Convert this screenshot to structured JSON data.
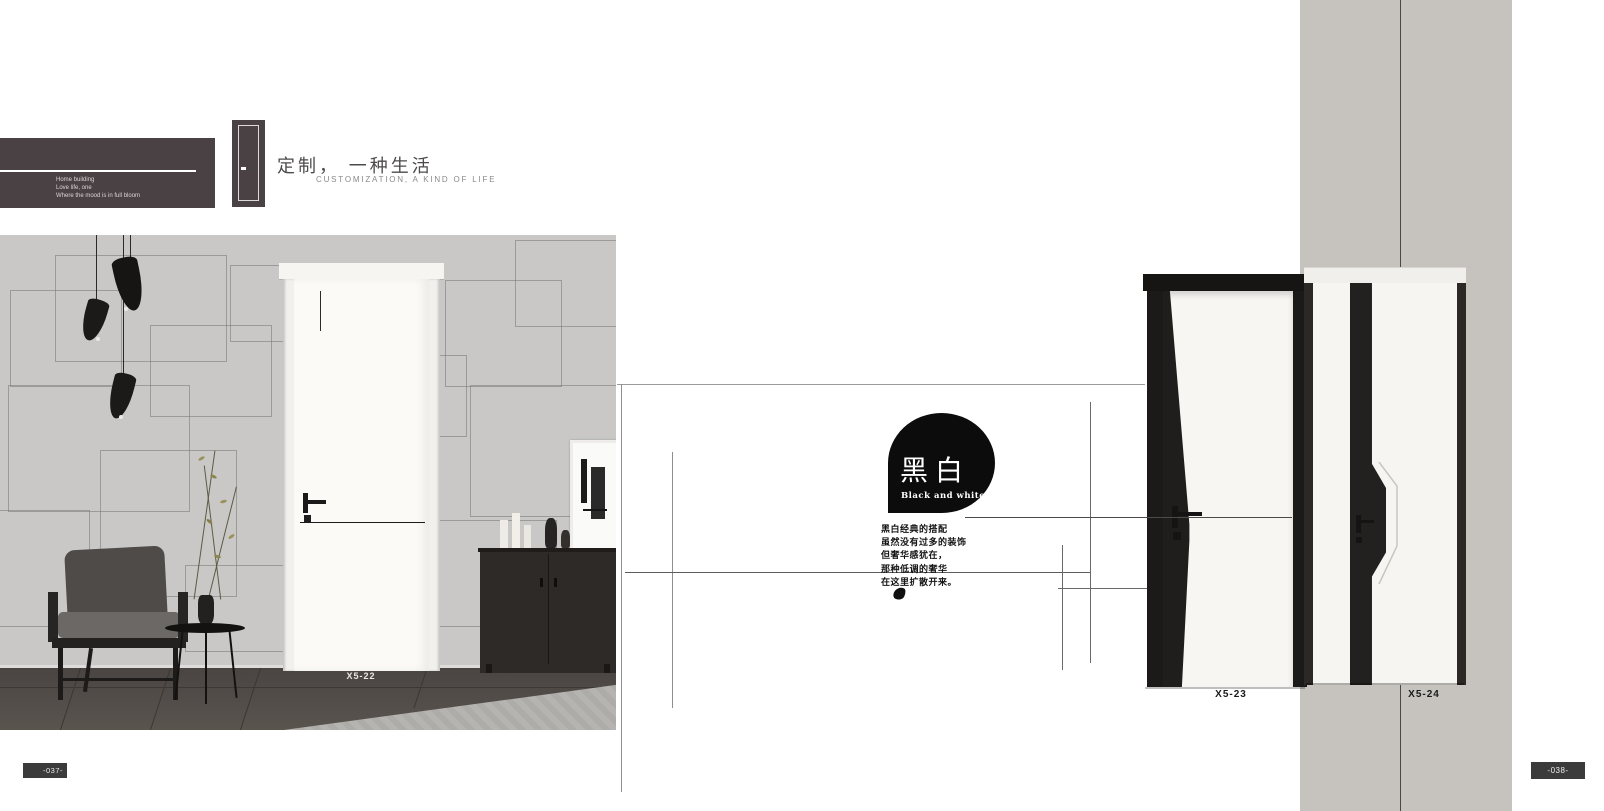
{
  "brand": {
    "name_bold": "SHI",
    "name_light": "SHANG",
    "slogans": [
      "Home building",
      "Love life, one",
      "Where the mood is in full bloom"
    ]
  },
  "tagline": {
    "cn": "定制， 一种生活",
    "en": "CUSTOMIZATION, A KIND OF LIFE"
  },
  "theme": {
    "title_cn": "黑白",
    "title_en": "Black and white",
    "description_lines": [
      "黑白经典的搭配",
      "虽然没有过多的装饰",
      "但奢华感犹在，",
      "那种低调的奢华",
      "在这里扩散开来。"
    ]
  },
  "products": {
    "left": {
      "model": "X5-22"
    },
    "middle": {
      "model": "X5-23"
    },
    "right": {
      "model": "X5-24"
    }
  },
  "pagination": {
    "left": "-037-",
    "right": "-038-"
  },
  "colors": {
    "logo_bg": "#4a4145",
    "gray_band": "#c6c3bf",
    "badge_black": "#0c0c0c",
    "page_badge_bg": "#3b3b3b"
  }
}
